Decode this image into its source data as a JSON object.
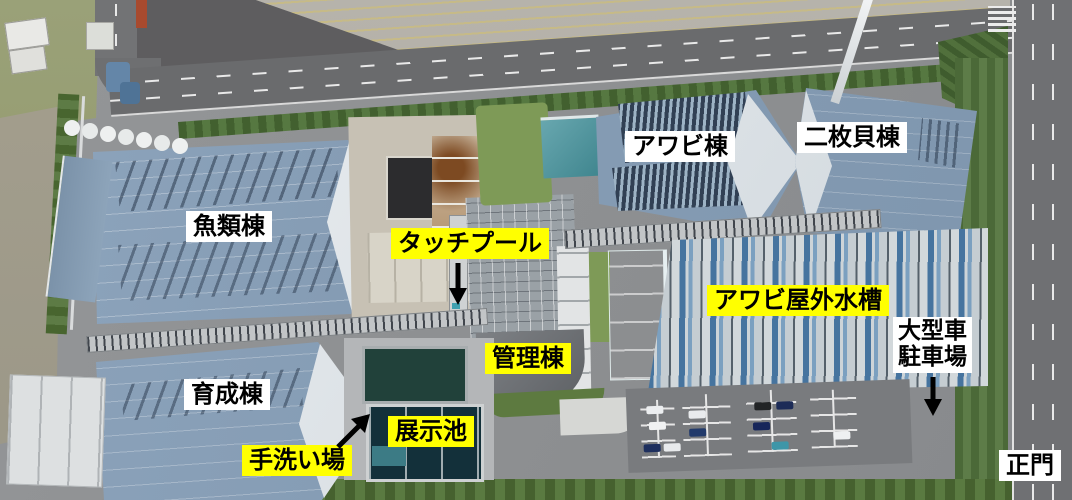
{
  "annotations": {
    "colors": {
      "highlight_label_bg": "#ffff00",
      "plain_label_bg": "#ffffff",
      "label_text": "#000000",
      "arrow": "#000000"
    },
    "labels": [
      {
        "id": "fish-building",
        "text": "魚類棟",
        "style": "plain"
      },
      {
        "id": "abalone-building",
        "text": "アワビ棟",
        "style": "plain"
      },
      {
        "id": "bivalve-building",
        "text": "二枚貝棟",
        "style": "plain"
      },
      {
        "id": "touch-pool",
        "text": "タッチプール",
        "style": "highlight",
        "arrow": "down"
      },
      {
        "id": "abalone-outdoor-tanks",
        "text": "アワビ屋外水槽",
        "style": "highlight"
      },
      {
        "id": "admin-building",
        "text": "管理棟",
        "style": "highlight"
      },
      {
        "id": "large-vehicle-parking",
        "text": "大型車駐車場",
        "line1": "大型車",
        "line2": "駐車場",
        "style": "plain",
        "arrow": "down"
      },
      {
        "id": "rearing-building",
        "text": "育成棟",
        "style": "plain"
      },
      {
        "id": "exhibition-pond",
        "text": "展示池",
        "style": "highlight"
      },
      {
        "id": "hand-washing-area",
        "text": "手洗い場",
        "style": "highlight",
        "arrow": "up-right"
      },
      {
        "id": "main-gate",
        "text": "正門",
        "style": "plain"
      }
    ]
  }
}
